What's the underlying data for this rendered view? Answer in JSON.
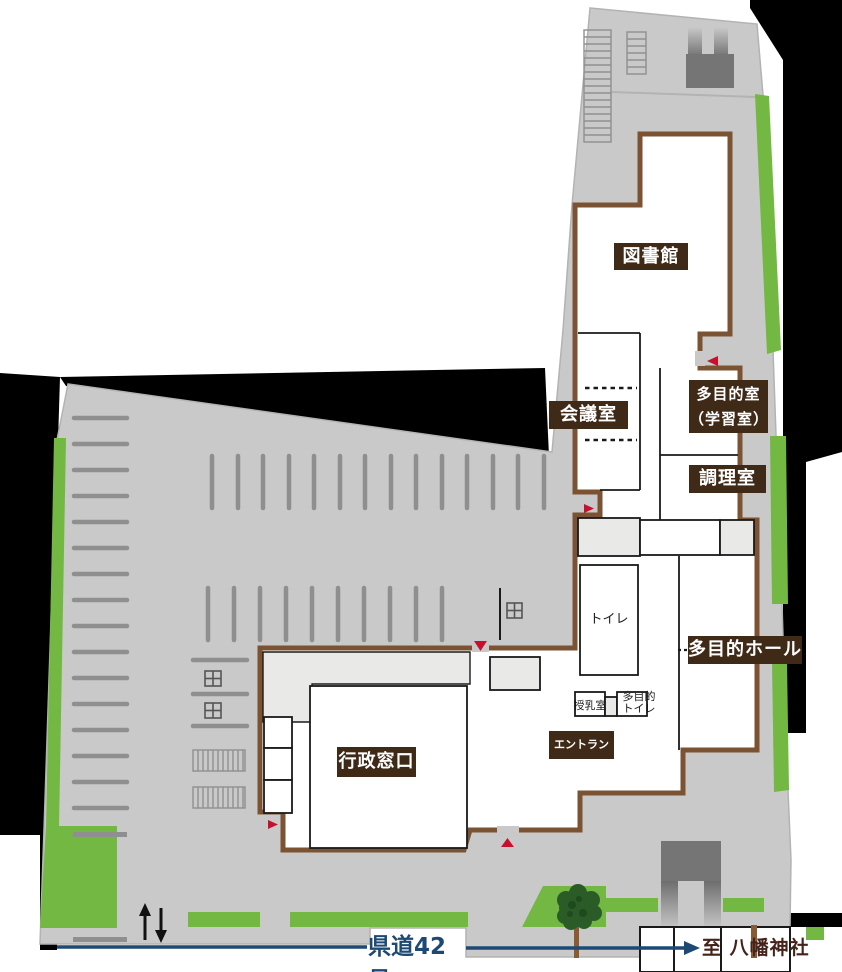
{
  "map": {
    "rooms": {
      "library": "図書館",
      "meeting_room": "会議室",
      "multipurpose_room_line1": "多目的室",
      "multipurpose_room_line2": "（学習室）",
      "cooking_room": "調理室",
      "multipurpose_hall": "多目的ホール",
      "toilet": "トイレ",
      "nursing_room": "授乳室",
      "accessible_toilet_line1": "多目的",
      "accessible_toilet_line2": "トイレ",
      "entrance": "エントランス",
      "admin_counter": "行政窓口"
    },
    "road": {
      "name": "県道42号",
      "destination": "至 八幡神社"
    },
    "icons": {
      "entrance_markers": "red-triangle-entrance-icon",
      "traffic": "two-way-arrows-icon",
      "road_direction": "road-arrow-icon",
      "tree": "tree-icon"
    },
    "colors": {
      "site_gray": "#c9c9c9",
      "interior_gray": "#e9e9e7",
      "wall_brown": "#7b5333",
      "label_bg": "#3f2a18",
      "green": "#72b843",
      "tree_green": "#2b5c28",
      "accent_red": "#c8102e",
      "road_blue": "#1d4a74",
      "structure_gray": "#757575",
      "destination_text": "#44231a",
      "outside_black": "#000000"
    }
  }
}
